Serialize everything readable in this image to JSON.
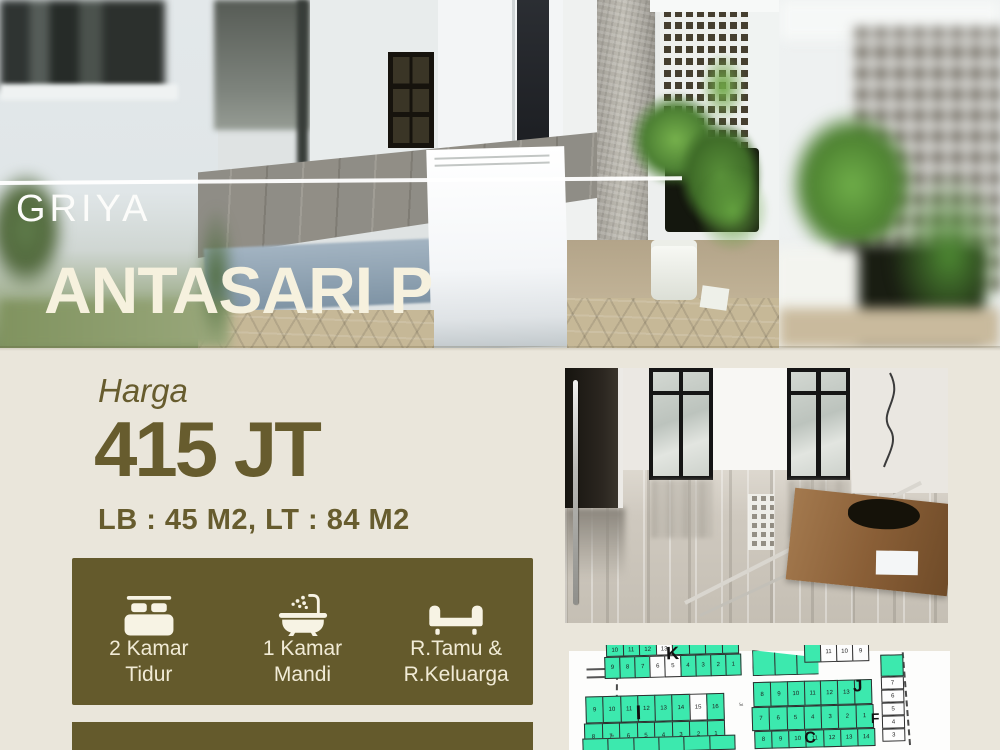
{
  "hero": {
    "brand_top": "GRIYA",
    "brand_bottom": "ANTASARI P"
  },
  "pricing": {
    "label": "Harga",
    "price": "415 JT",
    "specs": "LB : 45 M2, LT : 84 M2"
  },
  "features": {
    "items": [
      {
        "icon": "bed-icon",
        "line1": "2 Kamar",
        "line2": "Tidur"
      },
      {
        "icon": "bath-icon",
        "line1": "1 Kamar",
        "line2": "Mandi"
      },
      {
        "icon": "sofa-icon",
        "line1": "R.Tamu &",
        "line2": "R.Keluarga"
      }
    ]
  },
  "colors": {
    "olive": "#645a2c",
    "olive_text": "#675c2e",
    "cream_bg": "#eae6db",
    "cream_text": "#f1ebd6",
    "hero_title": "#f6f1de",
    "map_green": "#3ce9ae"
  },
  "map": {
    "rows": [
      {
        "x": 40,
        "y": -4,
        "w": 132,
        "h": 13,
        "cells": [
          "10",
          "11",
          "12",
          "13w",
          "",
          "",
          "",
          ""
        ]
      },
      {
        "x": 38,
        "y": 9,
        "w": 136,
        "h": 22,
        "cells": [
          "9",
          "8",
          "7",
          "6w",
          "5w",
          "4",
          "3",
          "2",
          "1"
        ]
      },
      {
        "x": 186,
        "y": 6,
        "w": 66,
        "h": 26,
        "clip": "polygon(0 0, 100% 35%, 100% 100%, 0 100%)",
        "cells": [
          "",
          "",
          ""
        ]
      },
      {
        "x": 238,
        "y": 0,
        "w": 16,
        "h": 20,
        "cells": [
          ""
        ]
      },
      {
        "x": 254,
        "y": 0,
        "w": 48,
        "h": 20,
        "cells": [
          "11w",
          "10w",
          "9w"
        ]
      },
      {
        "x": 18,
        "y": 48,
        "w": 138,
        "h": 27,
        "cells": [
          "9",
          "10",
          "11",
          "12",
          "13",
          "14",
          "15w",
          "16"
        ]
      },
      {
        "x": 16,
        "y": 75,
        "w": 140,
        "h": 27,
        "cells": [
          "8",
          "7",
          "6",
          "5",
          "4",
          "3",
          "2",
          "1"
        ]
      },
      {
        "x": 186,
        "y": 38,
        "w": 118,
        "h": 25,
        "cells": [
          "8",
          "9",
          "10",
          "11",
          "12",
          "13",
          ""
        ]
      },
      {
        "x": 184,
        "y": 63,
        "w": 121,
        "h": 24,
        "cells": [
          "7",
          "6",
          "5",
          "4",
          "3",
          "2",
          "1"
        ]
      },
      {
        "x": 314,
        "y": 14,
        "w": 22,
        "h": 22,
        "cells": [
          ""
        ]
      },
      {
        "x": 314,
        "y": 36,
        "w": 22,
        "h": 13,
        "cells": [
          "7w"
        ]
      },
      {
        "x": 314,
        "y": 49,
        "w": 22,
        "h": 13,
        "cells": [
          "6w"
        ]
      },
      {
        "x": 314,
        "y": 62,
        "w": 22,
        "h": 13,
        "cells": [
          "5w"
        ]
      },
      {
        "x": 314,
        "y": 75,
        "w": 22,
        "h": 13,
        "cells": [
          "4w"
        ]
      },
      {
        "x": 314,
        "y": 88,
        "w": 22,
        "h": 13,
        "cells": [
          "3w"
        ]
      },
      {
        "x": 14,
        "y": 90,
        "w": 152,
        "h": 15,
        "cells": [
          "",
          "",
          "",
          "",
          "",
          ""
        ]
      },
      {
        "x": 186,
        "y": 87,
        "w": 120,
        "h": 18,
        "cells": [
          "8",
          "9",
          "10",
          "11",
          "12",
          "13",
          "14"
        ]
      }
    ],
    "letters": [
      {
        "text": "K",
        "x": 100,
        "y": -2,
        "size": 18
      },
      {
        "text": "I",
        "x": 68,
        "y": 56,
        "size": 20
      },
      {
        "text": "J",
        "x": 286,
        "y": 36,
        "size": 17
      },
      {
        "text": "F",
        "x": 303,
        "y": 70,
        "size": 14
      },
      {
        "text": "C",
        "x": 236,
        "y": 88,
        "size": 16
      }
    ],
    "street_labels": [
      {
        "text": "Jl",
        "x": 176,
        "y": 58
      },
      {
        "text": "Jl",
        "x": 46,
        "y": 86
      }
    ]
  }
}
